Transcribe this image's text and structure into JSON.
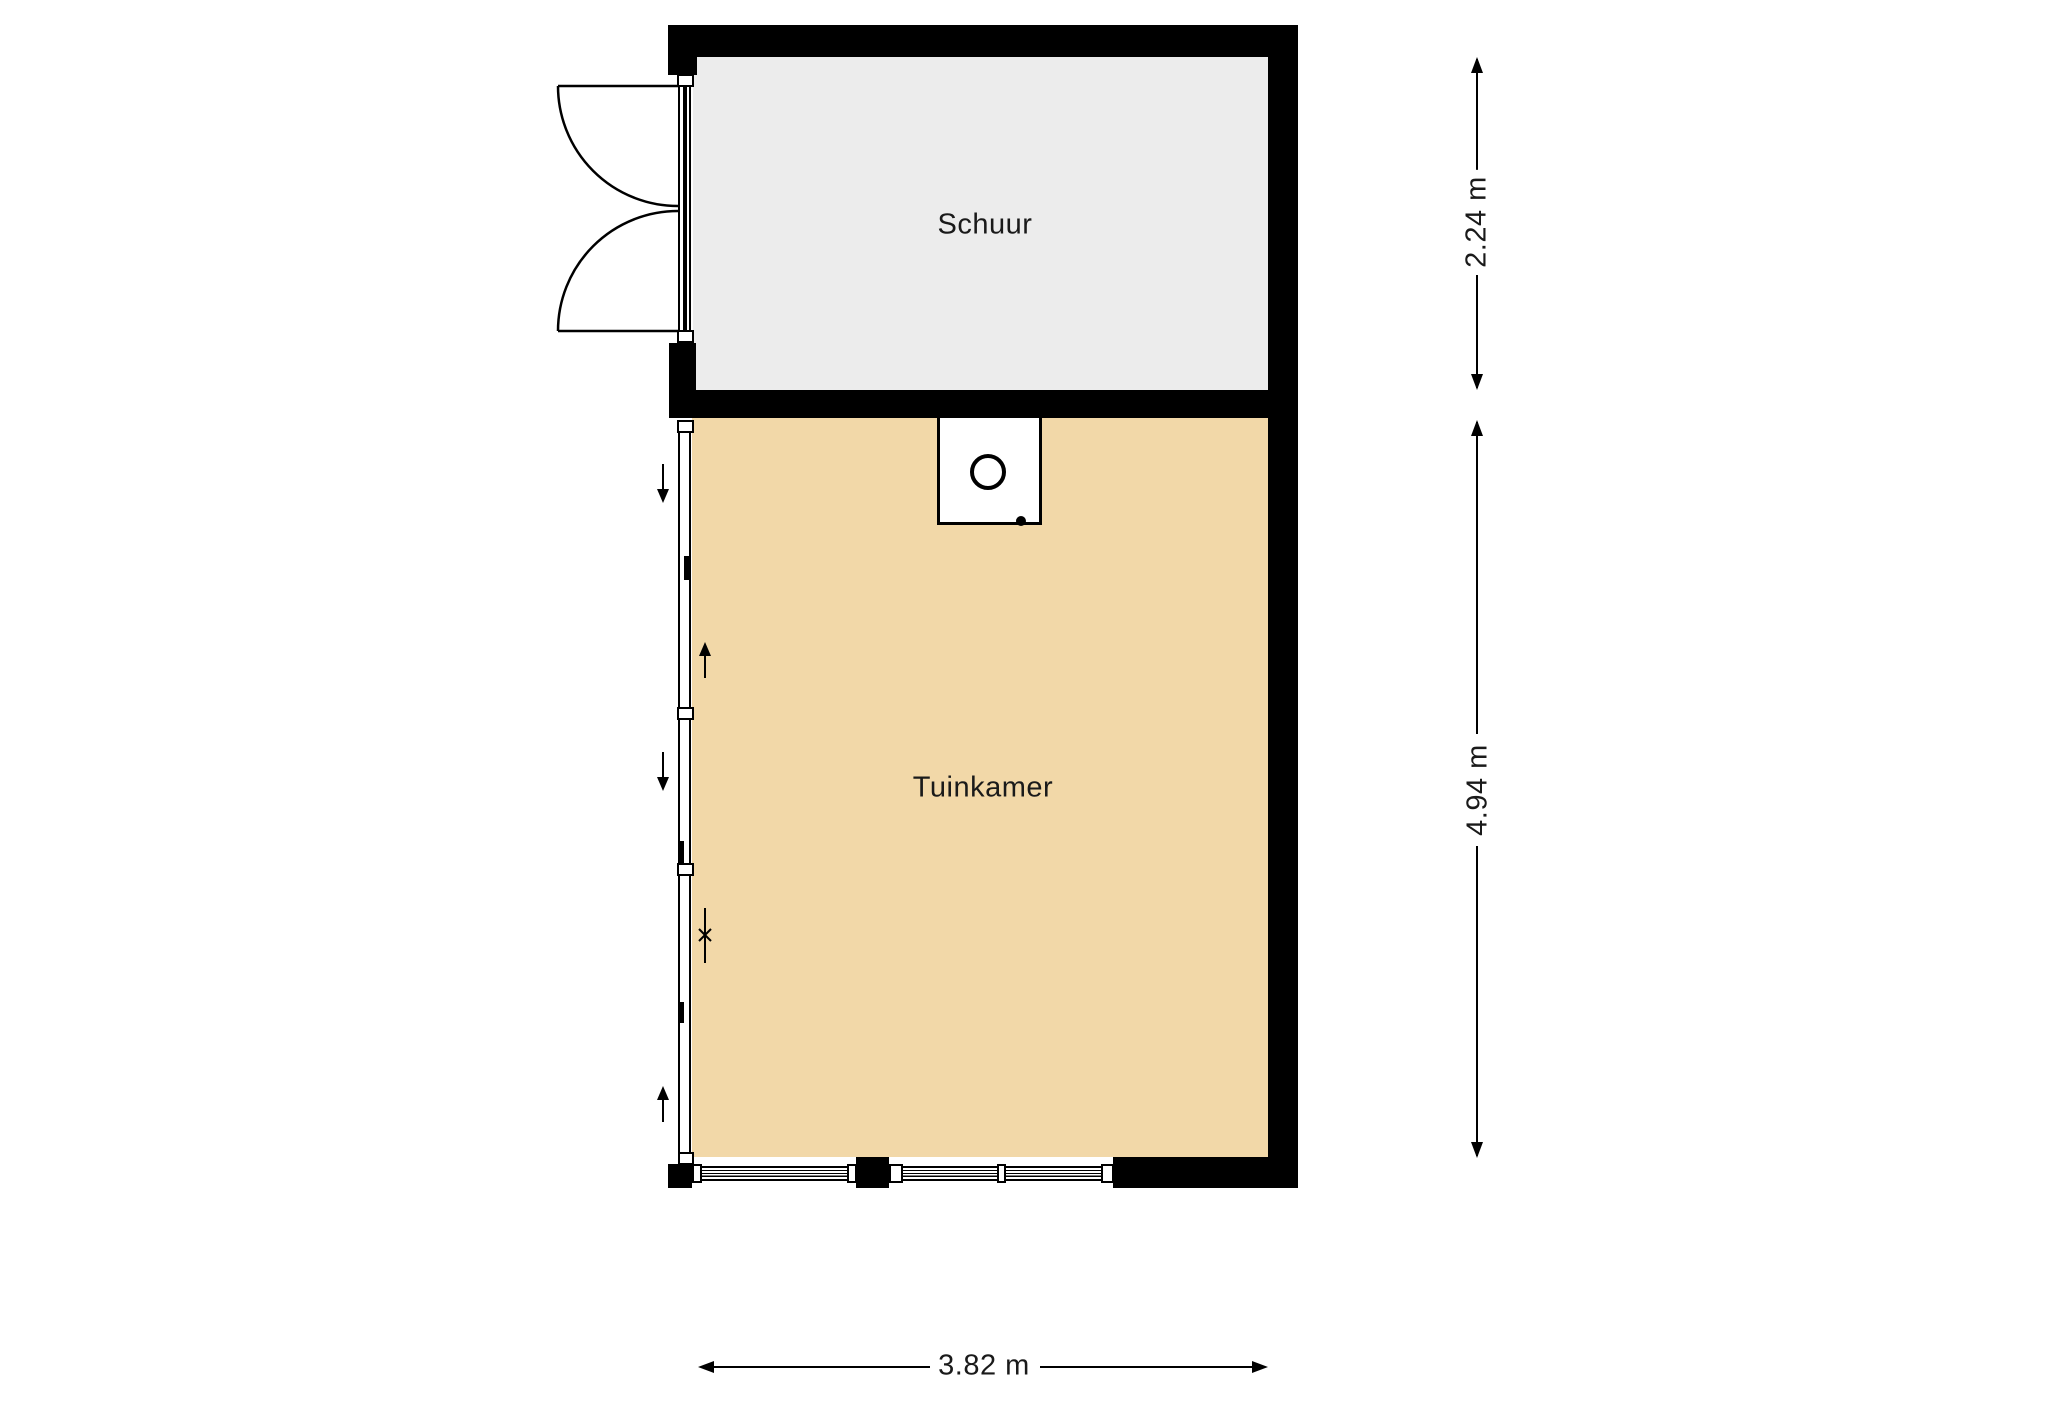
{
  "floorplan": {
    "rooms": [
      {
        "id": "schuur",
        "label": "Schuur",
        "floor_color": "#ececec"
      },
      {
        "id": "tuinkamer",
        "label": "Tuinkamer",
        "floor_color": "#f2d8a8"
      }
    ],
    "dimensions": [
      {
        "id": "schuur-depth",
        "label": "2.24 m",
        "orientation": "vertical"
      },
      {
        "id": "tuinkamer-depth",
        "label": "4.94 m",
        "orientation": "vertical"
      },
      {
        "id": "total-width",
        "label": "3.82 m",
        "orientation": "horizontal"
      }
    ],
    "colors": {
      "wall": "#000000",
      "background": "#ffffff",
      "schuur_floor": "#ececec",
      "tuinkamer_floor": "#f2d8a8",
      "text": "#1a1a1a"
    }
  }
}
